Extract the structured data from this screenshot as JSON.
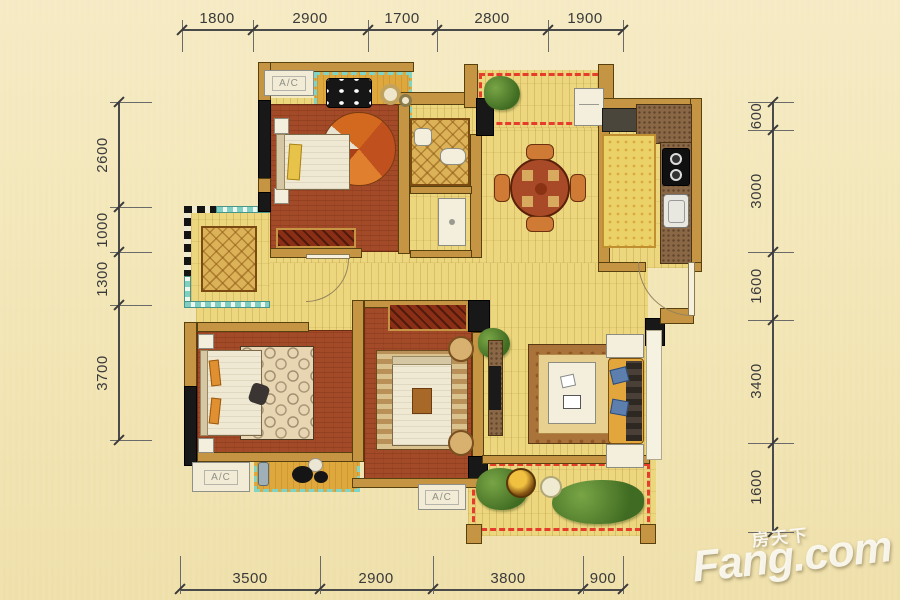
{
  "dims": {
    "top": [
      "1800",
      "2900",
      "1700",
      "2800",
      "1900"
    ],
    "bottom": [
      "3500",
      "2900",
      "3800",
      "900"
    ],
    "left": [
      "2600",
      "1000",
      "1300",
      "3700"
    ],
    "right": [
      "600",
      "3000",
      "1600",
      "3400",
      "1600"
    ]
  },
  "labels": {
    "ac": "A/C"
  },
  "watermark": {
    "cn": "房天下",
    "en": "Fang.com"
  },
  "colors": {
    "background": "#f2e6ba",
    "wall": "#c59544",
    "structural_wall": "#181818",
    "wood_floor": "#ecd77f",
    "bedroom_floor": "#a34b28",
    "balcony_rail_teal": "#7fd4c6",
    "open_balcony_dash": "#e63c2c",
    "kitchen_counter": "#8a6845",
    "dimension_text": "#3a3a3a",
    "watermark_white": "#fcfaf2"
  }
}
